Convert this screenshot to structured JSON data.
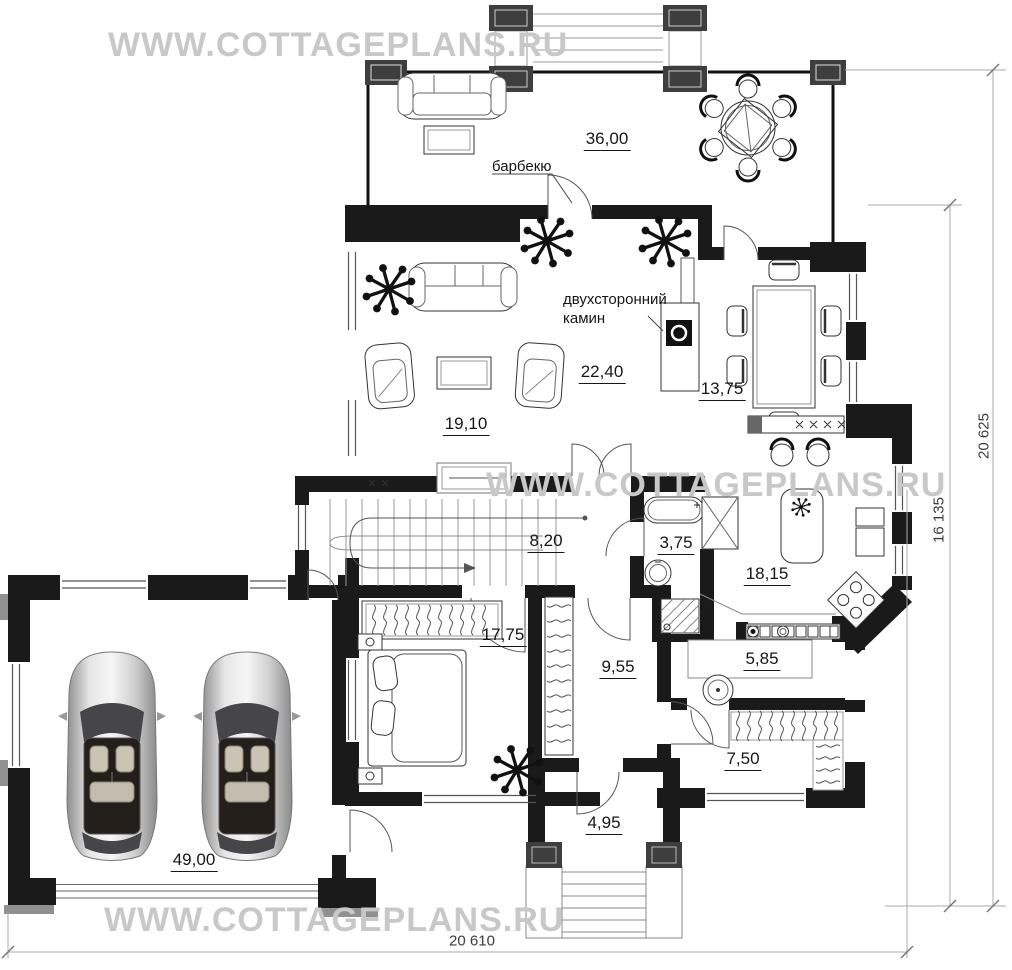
{
  "watermark": "WWW.COTTAGEPLANS.RU",
  "annotations": {
    "barbecue": "барбекю",
    "fireplace_line1": "двухсторонний",
    "fireplace_line2": "камин"
  },
  "rooms": {
    "terrace": "36,00",
    "living": "22,40",
    "dining": "13,75",
    "sitting": "19,10",
    "stair_hall": "8,20",
    "bathroom": "3,75",
    "kitchen": "18,15",
    "bedroom": "17,75",
    "hallway": "9,55",
    "utility": "5,85",
    "wardrobe": "7,50",
    "entrance": "4,95",
    "garage": "49,00"
  },
  "dimensions": {
    "outer_height": "20 625",
    "inner_height": "16 135",
    "total_width": "20 610"
  },
  "colors": {
    "wall": "#1a1a1a",
    "column": "#3e3e3e",
    "watermark": "#c8c8c8",
    "dimension_text": "#3c3c3c"
  }
}
